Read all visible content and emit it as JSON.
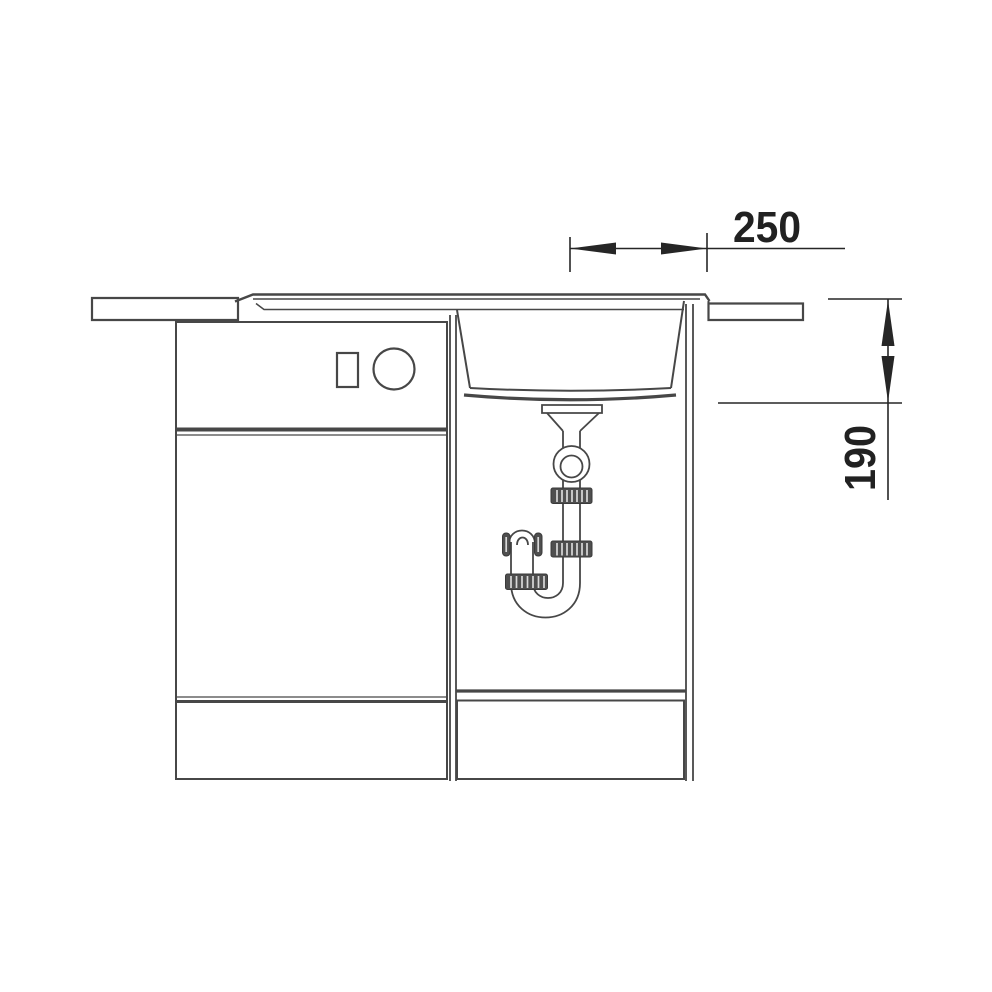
{
  "page": {
    "background_color": "#ffffff"
  },
  "diagram": {
    "type": "technical-line-drawing",
    "subject": "kitchen sink and base cabinet installation cross-section with drain trap",
    "line_color": "#474747",
    "dimension_color": "#262626",
    "fitting_fill_color": "#4f4f4f",
    "dimensions": {
      "horizontal_offset": {
        "label": "250"
      },
      "bowl_depth": {
        "label": "190"
      }
    },
    "components": [
      "left-countertop",
      "right-countertop",
      "sink-drainboard",
      "sink-rim",
      "sink-bowl",
      "drain-flange",
      "tailpipe",
      "ball-joint",
      "compression-nut-upper",
      "compression-nut-middle",
      "compression-nut-lower",
      "p-trap-u-bend",
      "trap-outlet-cap",
      "left-base-cabinet",
      "control-button",
      "control-knob",
      "left-cabinet-door",
      "left-cabinet-drawer",
      "sink-base-cabinet",
      "right-cabinet-drawer"
    ]
  }
}
